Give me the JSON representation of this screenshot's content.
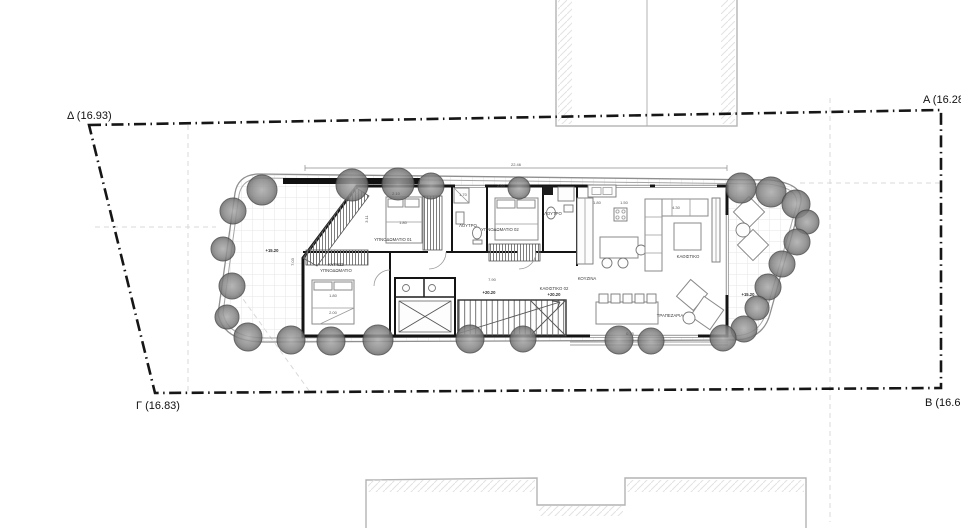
{
  "drawing": {
    "type": "architectural-floor-plan",
    "boundary_corner_labels": [
      {
        "text": "Δ (16.93)",
        "x": 67,
        "y": 119
      },
      {
        "text": "Α (16.28)",
        "x": 923,
        "y": 103
      },
      {
        "text": "Γ (16.83)",
        "x": 136,
        "y": 409
      },
      {
        "text": "Β (16.68)",
        "x": 925,
        "y": 406
      }
    ],
    "room_labels": [
      {
        "text": "ΥΠΝΟΔΩΜΑΤΙΟ 01",
        "x": 393,
        "y": 241
      },
      {
        "text": "ΛΟΥΤΡΟ",
        "x": 468,
        "y": 227
      },
      {
        "text": "ΥΠΝΟΔΩΜΑΤΙΟ 02",
        "x": 500,
        "y": 231
      },
      {
        "text": "ΛΟΥΤΡΟ",
        "x": 553,
        "y": 215
      },
      {
        "text": "ΚΥΡΙΩΣ",
        "x": 336,
        "y": 266
      },
      {
        "text": "ΥΠΝΟΔΩΜΑΤΙΟ",
        "x": 336,
        "y": 272
      },
      {
        "text": "ΚΟΥΖΙΝΑ",
        "x": 587,
        "y": 280
      },
      {
        "text": "ΚΑΘΙΣΤΙΚΟ 02",
        "x": 554,
        "y": 290
      },
      {
        "text": "ΚΑΘΙΣΤΙΚΟ",
        "x": 688,
        "y": 258
      },
      {
        "text": "ΤΡΑΠΕΖΑΡΙΑ",
        "x": 670,
        "y": 317
      }
    ],
    "dimension_labels": [
      {
        "text": "22.46",
        "x": 516,
        "y": 166,
        "rot": 0
      },
      {
        "text": "2.10",
        "x": 396,
        "y": 195,
        "rot": 0
      },
      {
        "text": "1.80",
        "x": 403,
        "y": 224,
        "rot": 0
      },
      {
        "text": "3.11",
        "x": 368,
        "y": 219,
        "rot": -90
      },
      {
        "text": "2.60",
        "x": 501,
        "y": 187,
        "rot": 0
      },
      {
        "text": "1.70",
        "x": 463,
        "y": 196,
        "rot": 0
      },
      {
        "text": "1.80",
        "x": 597,
        "y": 204,
        "rot": 0
      },
      {
        "text": "1.50",
        "x": 624,
        "y": 204,
        "rot": 0
      },
      {
        "text": "7.90",
        "x": 492,
        "y": 281,
        "rot": 0
      },
      {
        "text": "7.03",
        "x": 294,
        "y": 262,
        "rot": -90
      },
      {
        "text": "1.80",
        "x": 333,
        "y": 297,
        "rot": 0
      },
      {
        "text": "2.00",
        "x": 333,
        "y": 314,
        "rot": 0
      },
      {
        "text": "0.75",
        "x": 630,
        "y": 335,
        "rot": 0
      },
      {
        "text": "4.30",
        "x": 676,
        "y": 209,
        "rot": 0
      }
    ],
    "elevation_labels": [
      {
        "text": "+15.20",
        "x": 272,
        "y": 252
      },
      {
        "text": "+20.20",
        "x": 489,
        "y": 294
      },
      {
        "text": "+20.20",
        "x": 554,
        "y": 296
      },
      {
        "text": "+15.20",
        "x": 748,
        "y": 296
      }
    ],
    "trees": [
      {
        "x": 262,
        "y": 190,
        "r": 15
      },
      {
        "x": 352,
        "y": 185,
        "r": 16
      },
      {
        "x": 398,
        "y": 184,
        "r": 16
      },
      {
        "x": 431,
        "y": 186,
        "r": 13
      },
      {
        "x": 519,
        "y": 188,
        "r": 11
      },
      {
        "x": 741,
        "y": 188,
        "r": 15
      },
      {
        "x": 771,
        "y": 192,
        "r": 15
      },
      {
        "x": 796,
        "y": 204,
        "r": 14
      },
      {
        "x": 807,
        "y": 222,
        "r": 12
      },
      {
        "x": 797,
        "y": 242,
        "r": 13
      },
      {
        "x": 782,
        "y": 264,
        "r": 13
      },
      {
        "x": 768,
        "y": 287,
        "r": 13
      },
      {
        "x": 757,
        "y": 308,
        "r": 12
      },
      {
        "x": 744,
        "y": 329,
        "r": 13
      },
      {
        "x": 723,
        "y": 338,
        "r": 13
      },
      {
        "x": 651,
        "y": 341,
        "r": 13
      },
      {
        "x": 619,
        "y": 340,
        "r": 14
      },
      {
        "x": 523,
        "y": 339,
        "r": 13
      },
      {
        "x": 470,
        "y": 339,
        "r": 14
      },
      {
        "x": 378,
        "y": 340,
        "r": 15
      },
      {
        "x": 331,
        "y": 341,
        "r": 14
      },
      {
        "x": 291,
        "y": 340,
        "r": 14
      },
      {
        "x": 248,
        "y": 337,
        "r": 14
      },
      {
        "x": 233,
        "y": 211,
        "r": 13
      },
      {
        "x": 223,
        "y": 249,
        "r": 12
      },
      {
        "x": 232,
        "y": 286,
        "r": 13
      },
      {
        "x": 227,
        "y": 317,
        "r": 12
      }
    ],
    "colors": {
      "boundary": "#161616",
      "wall": "#141414",
      "tree_fill": "#8f8f8f",
      "tree_stroke": "#4a4a4a",
      "tile_grid": "#e6e6e6",
      "furniture": "#8a8a8a",
      "faint_reference": "#d9d9d9",
      "adjacent_building": "#b3b3b3"
    }
  }
}
